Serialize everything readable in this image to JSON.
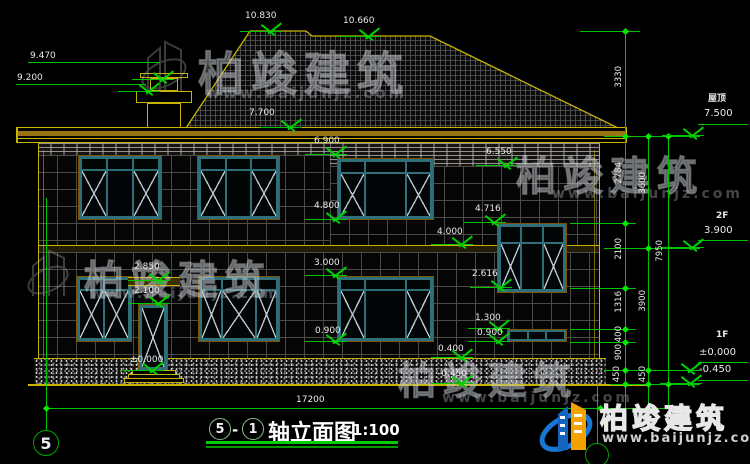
{
  "brand": {
    "name": "柏竣建筑",
    "url": "www.baijunjz.com"
  },
  "title_block": {
    "axis_start": "5",
    "separator": "-",
    "axis_end": "1",
    "name": "轴立面图",
    "scale": "1:100"
  },
  "axis": {
    "left_bubble": "5"
  },
  "levels": {
    "roof_label": "屋顶",
    "roof": "7.500",
    "f2_label": "2F",
    "f2": "3.900",
    "f1_label": "1F",
    "f1_zero": "±0.000",
    "f1_minus": "-0.450"
  },
  "elev": {
    "ridge_high": "10.830",
    "ridge_low": "10.660",
    "chimney_top": "9.470",
    "chimney_cap": "9.200",
    "eave": "7.700",
    "band_left": "6.900",
    "band_right": "6.550",
    "w2_sill": "4.800",
    "stair_head": "4.716",
    "floor_line": "4.000",
    "w1_head": "3.000",
    "canopy": "2.850",
    "stair_sill": "2.616",
    "door_head": "2.100",
    "small_head": "1.300",
    "small_sill": "0.900",
    "w1_sill": "0.900",
    "plinth_top": "0.400",
    "entry": "±0.000",
    "ground": "-0.450"
  },
  "dims": {
    "total_width": "17200",
    "v_inner": [
      "3330",
      "2784",
      "2100",
      "1316",
      "400",
      "900",
      "450"
    ],
    "v_mid": [
      "3600",
      "3900",
      "450"
    ],
    "v_outer": [
      "7950"
    ]
  }
}
